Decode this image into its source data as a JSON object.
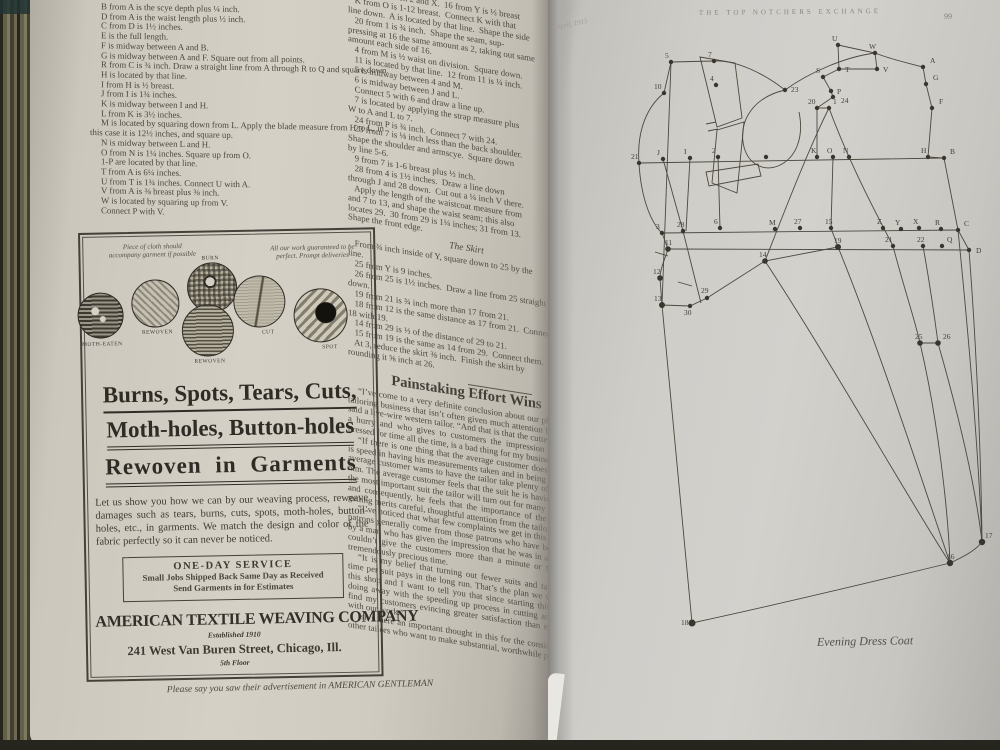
{
  "left_page": {
    "column1_lines": [
      "B from A is the scye depth plus ¼ inch.",
      "D from A is the waist length plus ½ inch.",
      "C from D is 1½ inches.",
      "E is the full length.",
      "F is midway between A and B.",
      "G is midway between A and F.  Square out from all points.",
      "R from C is ¾ inch.  Draw a straight line from A through R to Q and square down.",
      "H is located by that line.",
      "I from H is ½ breast.",
      "J from I is 1¾ inches.",
      "K is midway between I and H.",
      "L from K is 3½ inches.",
      "M is located by squaring down from L.  Apply the blade measure from H to L, in this case it is 12½ inches, and square up.",
      "N is midway between L and H.",
      "O from N is 1¼ inches.  Square up from O.",
      "1-P are located by that line.",
      "T from A is 6¼ inches.",
      "U from T is 1¾ inches.  Connect U with A.",
      "V from A is ⅜ breast plus ⅜ inch.",
      "W is located by squaring up from V.",
      "Connect P with V."
    ],
    "column2_lines": [
      "      way between 2 and X.  16 from Y is ⅓ breast",
      "   K from O is 1-12 breast.  Connect K with that",
      "line down.  A is located by that line.  Shape the side",
      "   20 from 1 is ¾ inch.  Shape the seam, sup-",
      "pressing at 16 the same amount as 2, taking out same",
      "amount each side of 16.",
      "   4 from M is ½ waist on division.  Square down.",
      "   11 is located by that line.  12 from 11 is ¼ inch.",
      "   5 is midway between 4 and M.",
      "   6 is midway between J and L.",
      "   Connect 5 with 6 and draw a line up.",
      "   7 is located by applying the strap measure plus",
      "W to A and L to 7.",
      "   24 from P is ¾ inch.  Connect 7 with 24.",
      "   23 from 7 is ⅛ inch less than the back shoulder.",
      "Shape the shoulder and armscye.  Square down",
      "by line 5-6.",
      "   9 from 7 is 1-6 breast plus ½ inch.",
      "   28 from 4 is 1½ inches.  Draw a line down",
      "through J and 28 down.  Cut out a ¼ inch V there.",
      "   Apply the length of the waistcoat measure from",
      "and 7 to 13, and shape the waist seam; this also",
      "locates 29.  30 from 29 is 1¼ inches; 31 from 13.",
      "Shape the front edge."
    ],
    "skirt": {
      "heading": "The Skirt",
      "lines": [
        "   From ¾ inch inside of Y, square down to 25 by the",
        "line.",
        "   25 from Y is 9 inches.",
        "   26 from 25 is 1½ inches.  Draw a line from 25 straight",
        "down.",
        "   19 from 21 is ¾ inch more than 17 from 21.",
        "   18 from 12 is the same distance as 17 from 21.  Connect",
        "18 with 19.",
        "   14 from 29 is ⅓ of the distance of 29 to 21.",
        "   15 from 19 is the same as 14 from 29.  Connect them.",
        "   At 3, reduce the skirt ⅜ inch.  Finish the skirt by",
        "rounding it ⅝ inch at 26."
      ]
    },
    "article": {
      "heading": "Painstaking Effort Wins",
      "paragraphs": [
        "“I’ve come to a very definite conclusion about our phase of the tailoring business that isn’t often given much attention by tailors,” said a live-wire western tailor.  “And that is that the cutter who is in a hurry and who gives to customers the impression that he is pressed for time all the time, is a bad thing for my business.",
        "“If there is one thing that the average customer doesn’t want it is speed in having his measurements taken and in being fitted.  The average customer wants to have the tailor take plenty of time with him.  The average customer feels that the suit he is having made is the most important suit the tailor will turn out for many a long day and consequently, he feels that the importance of the suit he is getting merits careful, thoughtful attention from the tailor.",
        "“I’ve noticed that what few complaints we get in this shop from patrons generally come from those patrons who have been served by a man who has given the impression that he was in a hurry and couldn’t give the customers more than a minute or two of his tremendously precious time.",
        "“It is my belief that turning out fewer suits and taking more time per suit pays in the long run.  That’s the plan we work on in this shop and I want to tell you that since starting this plan and doing away with the speeding up process in cutting and fitting I find my customers evincing greater satisfaction than ever before with our work.”",
        "Isn’t there an important thought in this for the consideration of other tailors who want to make substantial, worthwhile progress?"
      ]
    },
    "ad": {
      "note_left": "Piece of cloth should accompany garment if possible",
      "note_right": "All our work guaranteed to be perfect.  Prompt deliveries",
      "swatches": [
        {
          "label": "MOTH-EATEN"
        },
        {
          "label": "REWOVEN"
        },
        {
          "label": "BURN"
        },
        {
          "label": "REWOVEN"
        },
        {
          "label": "CUT"
        },
        {
          "label": "SPOT"
        }
      ],
      "headline_line1": "Burns, Spots, Tears, Cuts,",
      "headline_line2": "Moth-holes, Button-holes",
      "headline_line3": "Rewoven in Garments",
      "body": "Let us show you how we can by our weaving process, reweave damages such as tears, burns, cuts, spots, moth-holes, button-holes, etc., in garments.  We match the design and color of the fabric perfectly so it can never be noticed.",
      "service_title": "ONE-DAY SERVICE",
      "service_line1": "Small Jobs Shipped Back Same Day as Received",
      "service_line2": "Send Garments in for Estimates",
      "company_name": "AMERICAN TEXTILE WEAVING COMPANY",
      "company_established": "Established 1910",
      "company_address": "241 West Van Buren Street, Chicago, Ill.",
      "company_floor": "5th Floor"
    },
    "footer_line": "Please say you saw their advertisement in AMERICAN GENTLEMAN"
  },
  "right_page": {
    "header": "THE TOP NOTCHERS EXCHANGE",
    "page_number": "99",
    "date_note": "April, 1915",
    "caption": "Evening Dress Coat",
    "diagram": {
      "paths": [
        "M639,163 L944,158",
        "M662,233 L958,230",
        "M668,249 L969,250",
        "M838,45 L875,53 L877,69 L839,69 Z",
        "M823,77 L839,69",
        "M875,53 C893,60 908,63 923,67",
        "M923,67 L926,84 L932,108 L928,157",
        "M928,157 L944,158 L958,230 L969,250",
        "M823,77 L831,91 L833,97 L817,108",
        "M817,108 L829,108",
        "M817,108 L817,157",
        "M833,157 L831,228 L838,247",
        "M875,53 C845,57 810,72 785,90",
        "M785,90 C762,72 735,60 714,61",
        "M785,90 C755,97 740,118 743,142 C746,163 762,172 778,166 C797,158 804,136 799,112",
        "M829,108 C808,150 783,215 765,261",
        "M829,108 C850,165 877,215 893,246",
        "M671,62 L714,61",
        "M664,93 L671,62",
        "M664,93 C643,110 637,138 639,163",
        "M639,163 C641,200 652,224 662,233",
        "M662,233 L668,249 C664,262 660,269 660,278 L662,305",
        "M662,305 L690,306 L707,298",
        "M671,62 C668,150 664,240 662,305",
        "M663,159 L683,231 L701,303",
        "M690,158 L686,231",
        "M718,157 L720,228",
        "M700,57 L735,63 L742,118 L717,127 Z",
        "M717,130 L744,122 L737,193 L712,183 Z",
        "M706,172 L758,164 L761,176 L709,186 Z",
        "M707,298 L765,261 L838,247",
        "M765,261 C830,360 915,510 950,563",
        "M838,247 C880,350 925,490 950,563",
        "M893,246 C903,285 915,320 920,343",
        "M923,246 C930,285 935,320 938,343",
        "M920,343 L938,343",
        "M920,343 C938,420 948,510 950,563",
        "M938,343 C960,420 976,490 982,542",
        "M958,230 C968,330 978,440 982,542",
        "M969,250 C976,340 981,450 982,542",
        "M662,305 L692,623",
        "M692,623 C780,604 880,580 950,563",
        "M950,563 C963,557 975,551 982,542",
        "M655,252 L668,256",
        "M678,282 L692,286",
        "M706,124 L716,122",
        "M708,131 L718,129"
      ],
      "points": [
        {
          "t": "5",
          "x": 671,
          "y": 62
        },
        {
          "t": "7",
          "x": 714,
          "y": 61
        },
        {
          "t": "4",
          "x": 716,
          "y": 85
        },
        {
          "t": "10",
          "x": 664,
          "y": 93,
          "lx": -10
        },
        {
          "t": "23",
          "x": 785,
          "y": 90,
          "lx": 6,
          "ly": 2
        },
        {
          "t": "U",
          "x": 838,
          "y": 45
        },
        {
          "t": "W",
          "x": 875,
          "y": 53
        },
        {
          "t": "T",
          "x": 839,
          "y": 69,
          "lx": 6,
          "ly": 3
        },
        {
          "t": "V",
          "x": 877,
          "y": 69,
          "lx": 6,
          "ly": 3
        },
        {
          "t": "A",
          "x": 923,
          "y": 67,
          "lx": 7
        },
        {
          "t": "S",
          "x": 823,
          "y": 77,
          "lx": -7
        },
        {
          "t": "P",
          "x": 831,
          "y": 91,
          "lx": 6,
          "ly": 3
        },
        {
          "t": "24",
          "x": 833,
          "y": 97,
          "lx": 8,
          "ly": 6
        },
        {
          "t": "G",
          "x": 926,
          "y": 84,
          "lx": 7
        },
        {
          "t": "20",
          "x": 817,
          "y": 108,
          "lx": -9
        },
        {
          "t": "1",
          "x": 829,
          "y": 108,
          "lx": 4
        },
        {
          "t": "F",
          "x": 932,
          "y": 108,
          "lx": 7
        },
        {
          "t": "21",
          "x": 639,
          "y": 163,
          "lx": -8
        },
        {
          "t": "J",
          "x": 663,
          "y": 159
        },
        {
          "t": "I",
          "x": 690,
          "y": 158
        },
        {
          "t": "2",
          "x": 718,
          "y": 157
        },
        {
          "t": "",
          "x": 766,
          "y": 157
        },
        {
          "t": "K",
          "x": 817,
          "y": 157
        },
        {
          "t": "O",
          "x": 833,
          "y": 157
        },
        {
          "t": "N",
          "x": 849,
          "y": 157
        },
        {
          "t": "H",
          "x": 928,
          "y": 157,
          "lx": -7
        },
        {
          "t": "B",
          "x": 944,
          "y": 158,
          "lx": 6
        },
        {
          "t": "3",
          "x": 662,
          "y": 233
        },
        {
          "t": "28",
          "x": 683,
          "y": 231
        },
        {
          "t": "6",
          "x": 720,
          "y": 228
        },
        {
          "t": "M",
          "x": 775,
          "y": 229
        },
        {
          "t": "27",
          "x": 800,
          "y": 228
        },
        {
          "t": "15",
          "x": 831,
          "y": 228
        },
        {
          "t": "Z",
          "x": 883,
          "y": 228
        },
        {
          "t": "Y",
          "x": 901,
          "y": 229
        },
        {
          "t": "X",
          "x": 919,
          "y": 228
        },
        {
          "t": "R",
          "x": 941,
          "y": 229
        },
        {
          "t": "C",
          "x": 958,
          "y": 230,
          "lx": 6
        },
        {
          "t": "11",
          "x": 668,
          "y": 249,
          "lx": -3,
          "r": 2.8
        },
        {
          "t": "19",
          "x": 838,
          "y": 247,
          "lx": -4,
          "r": 3
        },
        {
          "t": "21",
          "x": 893,
          "y": 246,
          "lx": -8
        },
        {
          "t": "22",
          "x": 923,
          "y": 246
        },
        {
          "t": "Q",
          "x": 942,
          "y": 246,
          "lx": 5
        },
        {
          "t": "D",
          "x": 969,
          "y": 250,
          "lx": 7,
          "ly": 3
        },
        {
          "t": "14",
          "x": 765,
          "y": 261,
          "lx": -6,
          "r": 2.8
        },
        {
          "t": "12",
          "x": 660,
          "y": 278,
          "lx": -7,
          "r": 2.8
        },
        {
          "t": "13",
          "x": 662,
          "y": 305,
          "lx": -8,
          "r": 3
        },
        {
          "t": "30",
          "x": 690,
          "y": 306,
          "ly": 9
        },
        {
          "t": "29",
          "x": 707,
          "y": 298,
          "ly": -5
        },
        {
          "t": "25",
          "x": 920,
          "y": 343,
          "lx": -5,
          "r": 2.8
        },
        {
          "t": "26",
          "x": 938,
          "y": 343,
          "lx": 5,
          "r": 2.8
        },
        {
          "t": "17",
          "x": 982,
          "y": 542,
          "lx": 3,
          "r": 3.2
        },
        {
          "t": "16",
          "x": 950,
          "y": 563,
          "lx": -3,
          "r": 3.2
        },
        {
          "t": "18",
          "x": 692,
          "y": 623,
          "lx": -11,
          "ly": 2,
          "r": 3.5
        }
      ]
    }
  }
}
